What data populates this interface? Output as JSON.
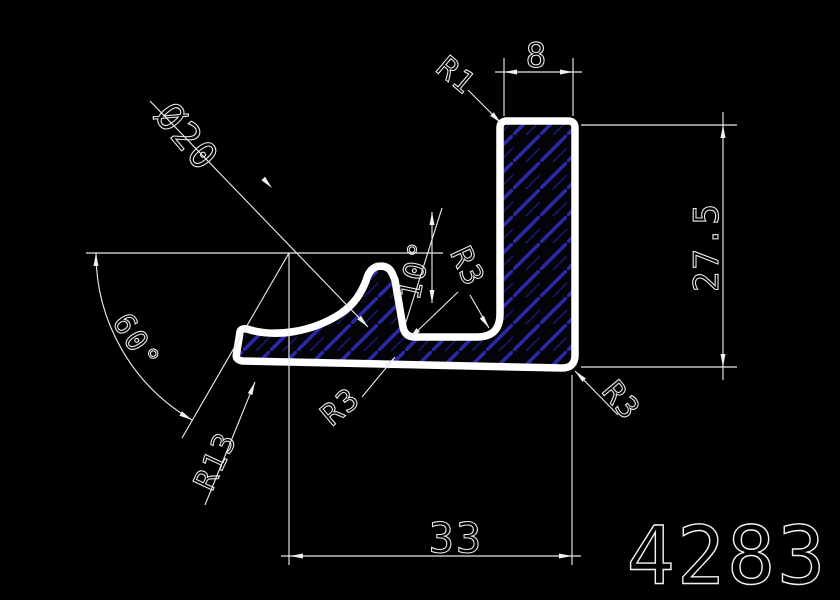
{
  "canvas": {
    "width": 840,
    "height": 600,
    "background": "#000003"
  },
  "colors": {
    "line": "#f0f0f0",
    "profile_outline": "#ffffff",
    "hatch_primary": "#2a2aa8",
    "hatch_secondary": "#191977"
  },
  "labels": {
    "dim_top_width": "8",
    "dim_right_height": "27.5",
    "dim_bottom_width": "33",
    "dim_diameter": "Ø20",
    "dim_angle_main": "60°",
    "dim_angle_lip": "10°",
    "radius_top_corner": "R1",
    "radius_lip_curve": "R13",
    "radius_valley": "R3",
    "radius_bottom": "R3",
    "radius_corner": "R3",
    "part_number": "4283"
  }
}
